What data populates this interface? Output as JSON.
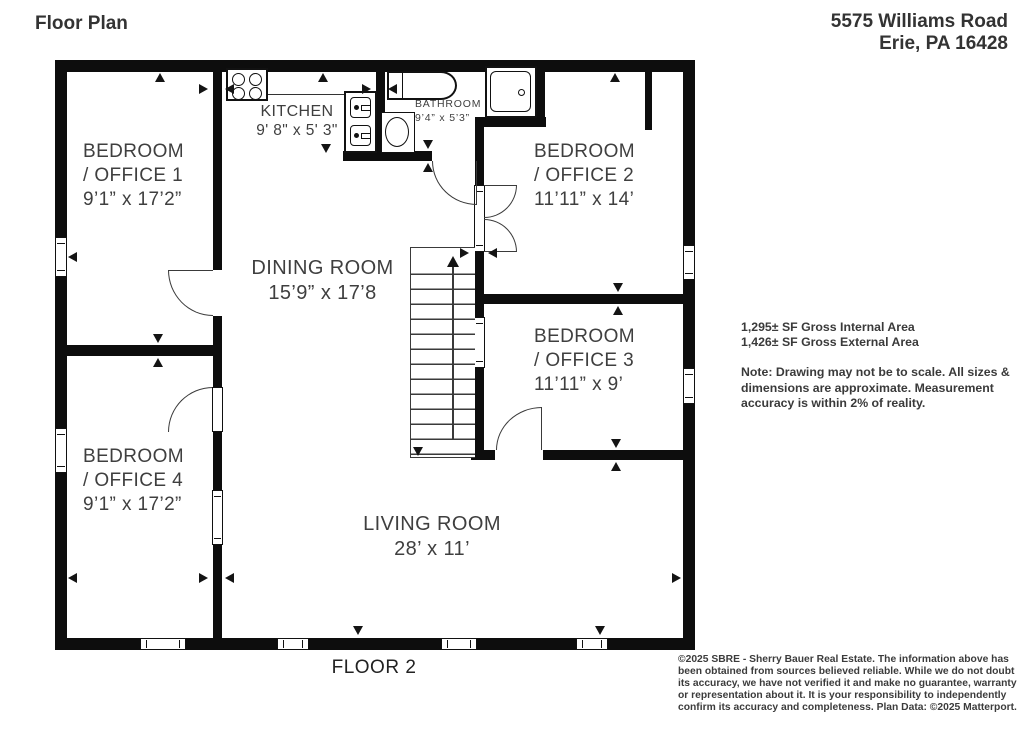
{
  "header": {
    "title": "Floor Plan",
    "address_line1": "5575 Williams Road",
    "address_line2": "Erie, PA 16428"
  },
  "rooms": [
    {
      "id": "bedroom-office-1",
      "line1": "BEDROOM",
      "line2": "/ OFFICE 1",
      "dims": "9’1” x 17’2”"
    },
    {
      "id": "kitchen",
      "line1": "KITCHEN",
      "dims": "9' 8\" x 5' 3\""
    },
    {
      "id": "bathroom",
      "line1": "BATHROOM",
      "dims": "9’4” x 5’3”"
    },
    {
      "id": "bedroom-office-2",
      "line1": "BEDROOM",
      "line2": "/ OFFICE 2",
      "dims": "11’11” x 14’"
    },
    {
      "id": "dining-room",
      "line1": "DINING ROOM",
      "dims": "15’9” x 17’8"
    },
    {
      "id": "bedroom-office-3",
      "line1": "BEDROOM",
      "line2": "/ OFFICE 3",
      "dims": "11’11” x 9’"
    },
    {
      "id": "bedroom-office-4",
      "line1": "BEDROOM",
      "line2": "/ OFFICE 4",
      "dims": "9’1” x 17’2”"
    },
    {
      "id": "living-room",
      "line1": "LIVING ROOM",
      "dims": "28’ x 11’"
    }
  ],
  "area_info": {
    "internal": "1,295± SF Gross Internal Area",
    "external": "1,426± SF Gross External Area",
    "note": "Note: Drawing may not be to scale. All sizes & dimensions are approximate. Measurement accuracy is within 2% of reality."
  },
  "footer": {
    "floor_label": "FLOOR 2",
    "disclaimer": "©2025 SBRE - Sherry Bauer Real Estate. The information above has been obtained from sources believed reliable. While we do not doubt its accuracy, we have not verified it and make no guarantee, warranty or representation about it. It is your responsibility to independently confirm its accuracy and completeness. Plan Data: ©2025 Matterport."
  },
  "colors": {
    "wall": "#0d0d0d",
    "line": "#3a3a3a",
    "text": "#3f3f3f",
    "background": "#ffffff"
  },
  "icons": {
    "stove": "stove-icon",
    "kitchen_sink": "sink-icon",
    "bathtub": "bathtub-icon",
    "toilet": "toilet-icon",
    "shower": "shower-icon",
    "stairs": "stairs-icon",
    "stairs_direction": "stairs-up-arrow-icon"
  }
}
